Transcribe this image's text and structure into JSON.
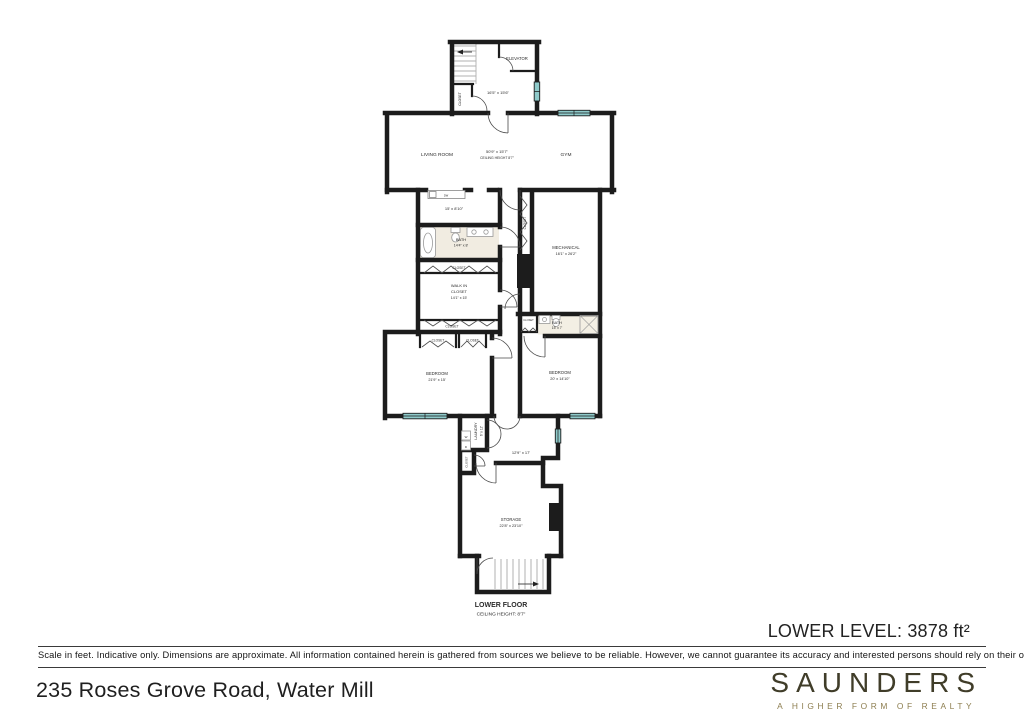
{
  "plan": {
    "rooms": {
      "elevator": "ELEVATOR",
      "entry_dims": "16'5\" x 15'6\"",
      "living_room": "LIVING ROOM",
      "living_dims": "50'9\" x 15'7\"",
      "living_ceiling": "CEILING HEIGHT 8'7\"",
      "gym": "GYM",
      "bar_dims": "15' x 8'10\"",
      "bath1": "BATH",
      "bath1_dims": "14'4\" x 8'",
      "walk_in_line1": "WALK IN",
      "walk_in_line2": "CLOSET",
      "walk_in_dims": "14'1\" x 15'",
      "mechanical": "MECHANICAL",
      "mechanical_dims": "16'1\" x 26'2\"",
      "bath2": "BATH",
      "bath2_dims": "15' x 7'",
      "bedroom1": "BEDROOM",
      "bedroom1_dims": "21'9\" x 15'",
      "bedroom2": "BEDROOM",
      "bedroom2_dims": "20' x 14'10\"",
      "laundry": "LAUNDRY",
      "laundry_dims": "6' x 12'",
      "hall_dims": "12'9\" x 17'",
      "storage": "STORAGE",
      "storage_dims": "22'8\" x 23'10\"",
      "closet": "CLOSET",
      "washer": "W",
      "dryer": "D",
      "dishwasher": "DW"
    },
    "floor_label": "LOWER FLOOR",
    "floor_ceiling": "CEILING HEIGHT: 8'7\"",
    "colors": {
      "wall": "#1c1c1c",
      "window": "#8ecaca",
      "bath_floor": "#f1ece1"
    }
  },
  "footer": {
    "level_area": "LOWER LEVEL: 3878 ft²",
    "disclaimer": "Scale in feet. Indicative only. Dimensions are approximate. All information contained herein is gathered from sources we believe to be reliable. However, we cannot guarantee its accuracy and interested persons should rely on their own inquiries .",
    "address": "235 Roses Grove Road, Water Mill"
  },
  "branding": {
    "name": "SAUNDERS",
    "tagline": "A HIGHER FORM OF REALTY",
    "name_color": "#403d29",
    "tagline_color": "#8d7e50"
  }
}
